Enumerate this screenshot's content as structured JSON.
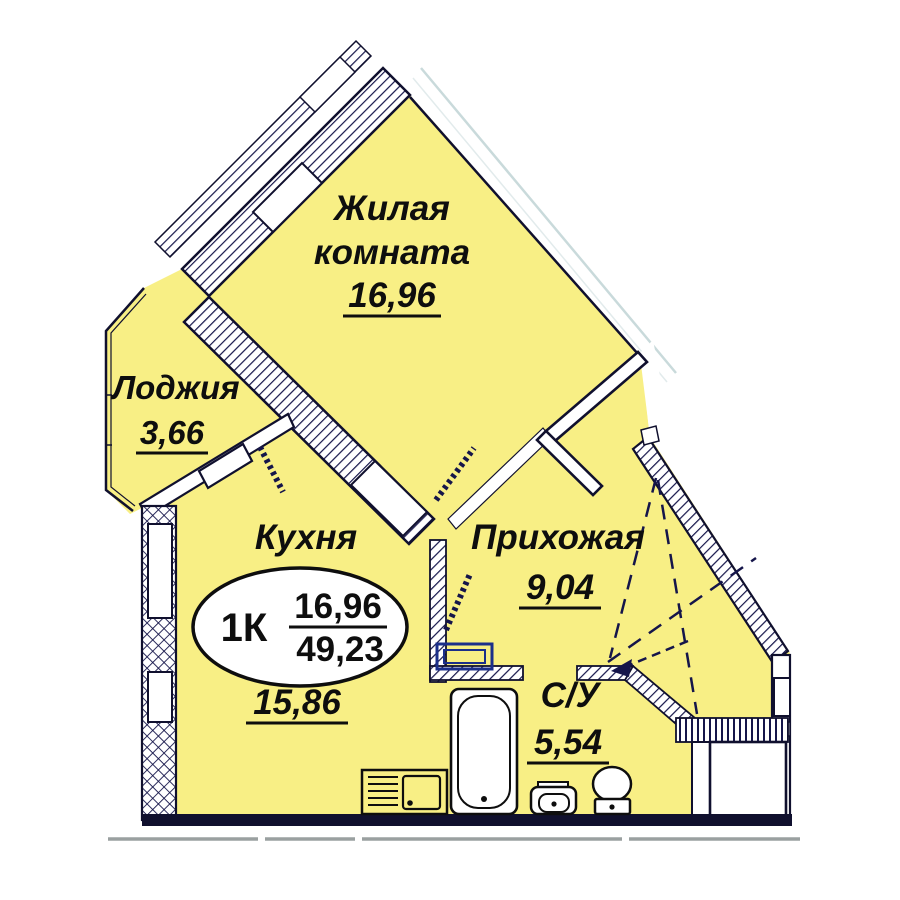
{
  "plan": {
    "title": "1-room apartment floor plan",
    "colors": {
      "room_fill": "#F8EF85",
      "wall_color": "#10102e",
      "hatch_color": "#15154a",
      "fixture_blue": "#1b2f8a",
      "facade_line": "#c9dadb",
      "slab_line": "#9aa0a0"
    },
    "rooms": {
      "living": {
        "name_line1": "Жилая",
        "name_line2": "комната",
        "area": "16,96"
      },
      "loggia": {
        "name": "Лоджия",
        "area": "3,66"
      },
      "kitchen": {
        "name": "Кухня",
        "area": "15,86"
      },
      "hallway": {
        "name": "Прихожая",
        "area": "9,04"
      },
      "bathroom": {
        "name": "С/У",
        "area": "5,54"
      }
    },
    "summary": {
      "type": "1К",
      "living_area": "16,96",
      "total_area": "49,23"
    },
    "fixtures": [
      "bathtub",
      "sink",
      "toilet",
      "stove-sink-counter",
      "washing-machine",
      "wardrobe-dashed"
    ]
  }
}
